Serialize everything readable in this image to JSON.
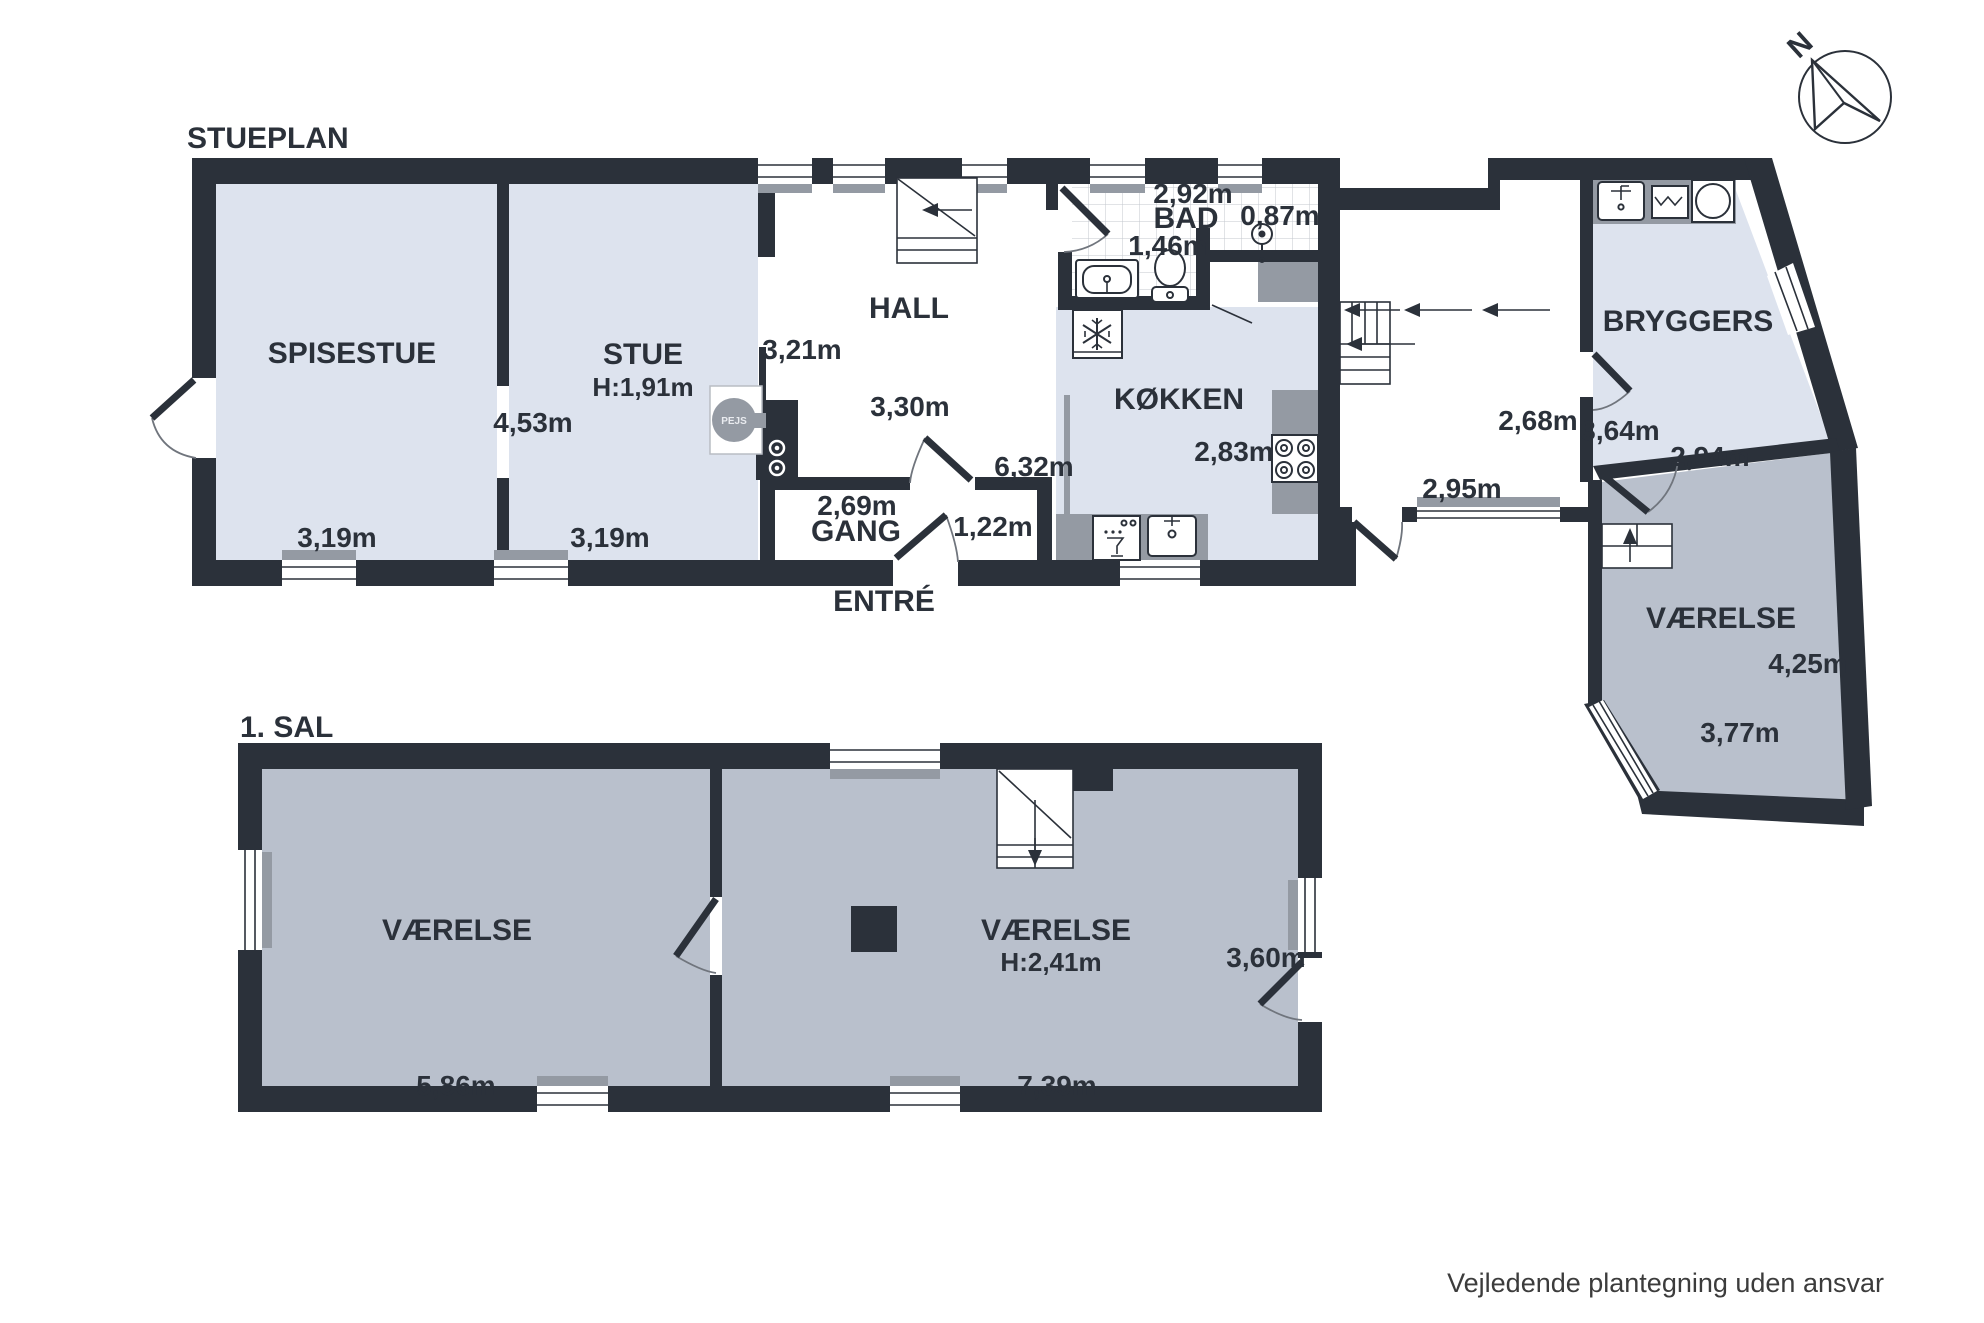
{
  "colors": {
    "wall": "#2b313a",
    "room_blue": "#dde3ee",
    "room_gray": "#b9c0cc",
    "counter_gray": "#949aa3",
    "background": "#ffffff"
  },
  "stueplan": {
    "title": "STUEPLAN",
    "spisestue": {
      "name": "SPISESTUE",
      "width": "3,19m"
    },
    "stue": {
      "name": "STUE",
      "height_label": "H:1,91m",
      "width": "3,19m",
      "depth": "4,53m"
    },
    "hall": {
      "name": "HALL",
      "dim1": "3,21m",
      "dim2": "3,30m",
      "dim3": "6,32m"
    },
    "gang": {
      "name": "GANG",
      "dim1": "2,69m",
      "dim2": "1,22m"
    },
    "entre": {
      "name": "ENTRÉ"
    },
    "bad": {
      "name": "BAD",
      "dim1": "2,92m",
      "dim2": "1,46m",
      "dim3": "0,87m"
    },
    "kokken": {
      "name": "KØKKEN",
      "dim1": "2,83m"
    },
    "mellemgang": {
      "dim1": "2,68m",
      "dim2": "2,95m"
    },
    "bryggers": {
      "name": "BRYGGERS",
      "dim1": "3,64m",
      "dim2": "2,94m"
    },
    "vaerelse": {
      "name": "VÆRELSE",
      "dim1": "4,25m",
      "dim2": "3,77m"
    },
    "pejs": {
      "label": "PEJS"
    }
  },
  "sal": {
    "title": "1. SAL",
    "vaerelse_left": {
      "name": "VÆRELSE",
      "width": "5,86m"
    },
    "vaerelse_right": {
      "name": "VÆRELSE",
      "height_label": "H:2,41m",
      "dim1": "3,60m",
      "width": "7,39m"
    }
  },
  "compass": {
    "label": "N"
  },
  "footer": {
    "disclaimer": "Vejledende plantegning uden ansvar"
  }
}
